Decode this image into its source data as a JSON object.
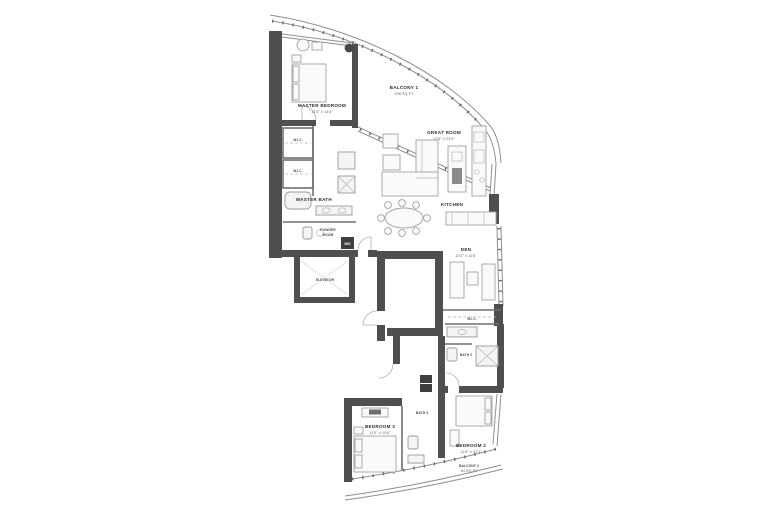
{
  "page": {
    "background": "#ffffff",
    "type": "residential floor plan"
  },
  "palette": {
    "wall": "#4f4f4f",
    "thin_wall": "#6f6f6f",
    "glass_line": "#8f8f8f",
    "furniture_line": "#a2a2a2",
    "label_text": "#2e2e2e",
    "dim_text": "#5a5a5a",
    "dark_box": "#3f3f3f",
    "background": "#ffffff"
  },
  "rooms": {
    "master_bedroom": {
      "name": "MASTER BEDROOM",
      "dims": "13'4\" x 14'8\""
    },
    "balcony_1": {
      "name": "BALCONY 1",
      "dims": "398 SQ FT"
    },
    "great_room": {
      "name": "GREAT ROOM",
      "dims": "17'6\" x 23'4\""
    },
    "kitchen": {
      "name": "KITCHEN"
    },
    "den": {
      "name": "DEN",
      "dims": "10'2\" x 11'6\""
    },
    "master_bath": {
      "name": "MASTER BATH"
    },
    "wic_1": {
      "name": "W.I.C."
    },
    "wic_2": {
      "name": "W.I.C."
    },
    "powder_room": {
      "line1": "POWDER",
      "line2": "ROOM"
    },
    "laundry": {
      "name": "W/D"
    },
    "elevator": {
      "name": "ELEVATOR"
    },
    "bedroom_3": {
      "name": "BEDROOM 3",
      "dims": "11'0\" x 14'6\""
    },
    "bath_3": {
      "name": "BATH 3"
    },
    "bath_2": {
      "name": "BATH 2"
    },
    "wic_3": {
      "name": "W.I.C."
    },
    "bedroom_2": {
      "name": "BEDROOM 2",
      "dims": "11'8\" x 12'4\""
    },
    "balcony_2": {
      "name": "BALCONY 2",
      "dims": "64 SQ FT"
    }
  }
}
